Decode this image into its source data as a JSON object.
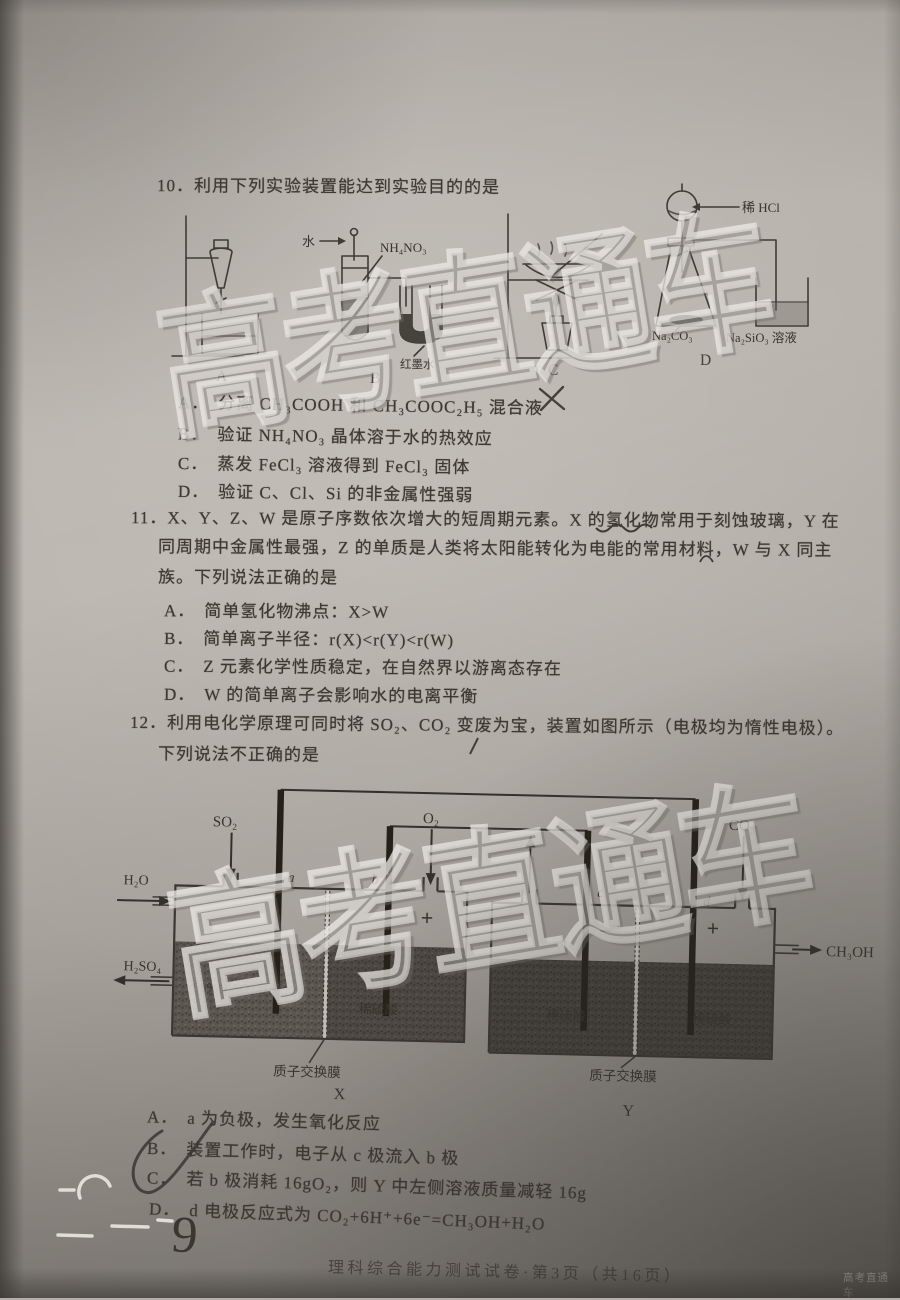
{
  "page": {
    "footer": "理科综合能力测试试卷·第3页（共16页）",
    "watermark": "高考直通车",
    "watermark_small": "高考直通车",
    "handwriting": {
      "page_number": "9"
    }
  },
  "q10": {
    "stem": "10．利用下列实验装置能达到实验目的的是",
    "apparatus": {
      "label_a": "A",
      "label_b": "B",
      "label_c": "C",
      "label_d": "D",
      "water": "水",
      "ammonium_nitrate": "NH₄NO₃",
      "red_ink": "红墨水",
      "dilute_hcl": "稀 HCl",
      "sodium_carbonate": "Na₂CO₃",
      "sodium_silicate": "Na₂SiO₃ 溶液"
    },
    "options": [
      {
        "label": "A．",
        "text": "分离 CH₃COOH 和 CH₃COOC₂H₅ 混合液"
      },
      {
        "label": "B．",
        "text": "验证 NH₄NO₃ 晶体溶于水的热效应"
      },
      {
        "label": "C．",
        "text": "蒸发 FeCl₃ 溶液得到 FeCl₃ 固体"
      },
      {
        "label": "D．",
        "text": "验证 C、Cl、Si 的非金属性强弱"
      }
    ]
  },
  "q11": {
    "stem_lines": [
      "11．X、Y、Z、W 是原子序数依次增大的短周期元素。X 的氢化物常用于刻蚀玻璃，Y 在",
      "同周期中金属性最强，Z 的单质是人类将太阳能转化为电能的常用材料，W 与 X 同主",
      "族。下列说法正确的是"
    ],
    "options": [
      {
        "label": "A．",
        "text": "简单氢化物沸点：X>W"
      },
      {
        "label": "B．",
        "text": "简单离子半径：r(X)<r(Y)<r(W)"
      },
      {
        "label": "C．",
        "text": "Z 元素化学性质稳定，在自然界以游离态存在"
      },
      {
        "label": "D．",
        "text": "W 的简单离子会影响水的电离平衡"
      }
    ]
  },
  "q12": {
    "stem_lines": [
      "12．利用电化学原理可同时将 SO₂、CO₂ 变废为宝，装置如图所示（电极均为惰性电极）。",
      "下列说法不正确的是"
    ],
    "diagram": {
      "gas_so2": "SO₂",
      "gas_o2": "O₂",
      "gas_co2": "CO₂",
      "water_in": "H₂O",
      "acid_out": "H₂SO₄",
      "product_out": "CH₃OH",
      "electrode_a": "a",
      "electrode_b": "b",
      "electrode_c": "c",
      "electrode_d": "d",
      "left_solution": "50%H₂SO₄溶液",
      "dilute_acid_x": "稀硫酸",
      "dilute_acid_y_left": "稀硫酸",
      "dilute_acid_y_right": "稀硫酸",
      "membrane_x": "质子交换膜",
      "membrane_y": "质子交换膜",
      "cell_x": "X",
      "cell_y": "Y",
      "plus_b": "+",
      "minus_c": "−",
      "plus_d": "+"
    },
    "options": [
      {
        "label": "A．",
        "text": "a 为负极，发生氧化反应"
      },
      {
        "label": "B．",
        "text": "装置工作时，电子从 c 极流入 b 极"
      },
      {
        "label": "C．",
        "text": "若 b 极消耗 16gO₂，则 Y 中左侧溶液质量减轻 16g"
      },
      {
        "label": "D．",
        "text": "d 电极反应式为 CO₂+6H⁺+6e⁻=CH₃OH+H₂O"
      }
    ]
  }
}
